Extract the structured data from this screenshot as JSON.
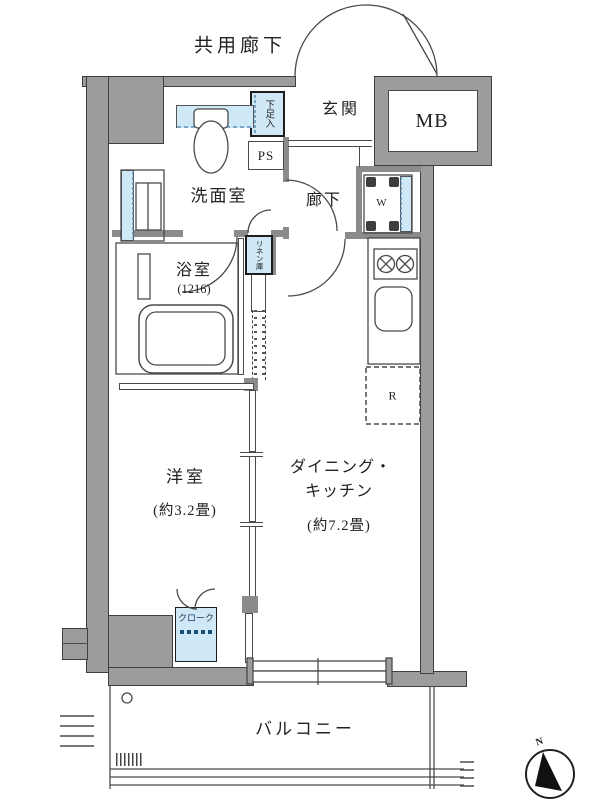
{
  "labels": {
    "common_corridor": "共用廊下",
    "entrance": "玄関",
    "meter_box": "MB",
    "shoe_cabinet": "下足入",
    "pipe_space": "PS",
    "washroom": "洗面室",
    "hallway": "廊下",
    "washer": "W",
    "bathroom": "浴室",
    "bathroom_size": "(1216)",
    "linen_closet": "リネン庫",
    "fridge": "R",
    "western_room": "洋室",
    "western_room_size": "(約3.2畳)",
    "dining_kitchen_line1": "ダイニング・",
    "dining_kitchen_line2": "キッチン",
    "dining_kitchen_size": "(約7.2畳)",
    "cloak": "クローク",
    "balcony": "バルコニー",
    "north": "N"
  },
  "colors": {
    "wall_gray": "#9c9c9c",
    "accent_blue": "#cfe8f6",
    "line_dark": "#4a4a4a",
    "dashed_blue": "#4d7fa8",
    "needle_black": "#111111"
  }
}
